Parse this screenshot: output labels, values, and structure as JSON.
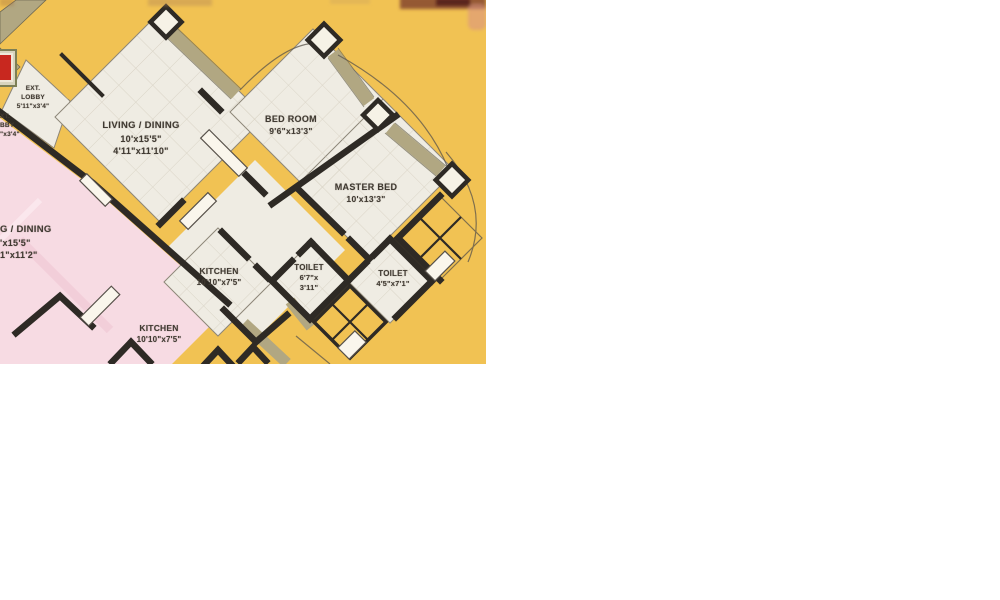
{
  "page": {
    "background": "#ffffff",
    "width": 1000,
    "height": 600
  },
  "floorplan": {
    "type": "apartment-floor-plan-scan",
    "region": {
      "x": 0,
      "y": 0,
      "width": 486,
      "height": 364
    },
    "colors": {
      "background": "#f1c253",
      "room_fill": "#efece3",
      "adjacent_unit_fill": "#f7dbe3",
      "wall": "#2e2a25",
      "balcony_band": "#b1a782",
      "stamp_red": "#c8281f"
    },
    "labels": [
      {
        "id": "ext-lobby",
        "lines": [
          "EXT.",
          "LOBBY",
          "5'11\"x3'4\""
        ]
      },
      {
        "id": "ext-lobby-cut",
        "lines": [
          "XT.",
          "BBY",
          "\"x3'4\""
        ]
      },
      {
        "id": "living-dining",
        "lines": [
          "LIVING / DINING",
          "10'x15'5\"",
          "4'11\"x11'10\""
        ]
      },
      {
        "id": "bed-room",
        "lines": [
          "BED ROOM",
          "9'6\"x13'3\""
        ]
      },
      {
        "id": "master-bed",
        "lines": [
          "MASTER BED",
          "10'x13'3\""
        ]
      },
      {
        "id": "living-dining-cut",
        "lines": [
          "G / DINING",
          "'x15'5\"",
          "1\"x11'2\""
        ]
      },
      {
        "id": "kitchen",
        "lines": [
          "KITCHEN",
          "10'10\"x7'5\""
        ]
      },
      {
        "id": "toilet-1",
        "lines": [
          "TOILET",
          "6'7\"x",
          "3'11\""
        ]
      },
      {
        "id": "toilet-2",
        "lines": [
          "TOILET",
          "4'5\"x7'1\""
        ]
      },
      {
        "id": "kitchen-2",
        "lines": [
          "KITCHEN",
          "10'10\"x7'5\""
        ]
      }
    ]
  }
}
